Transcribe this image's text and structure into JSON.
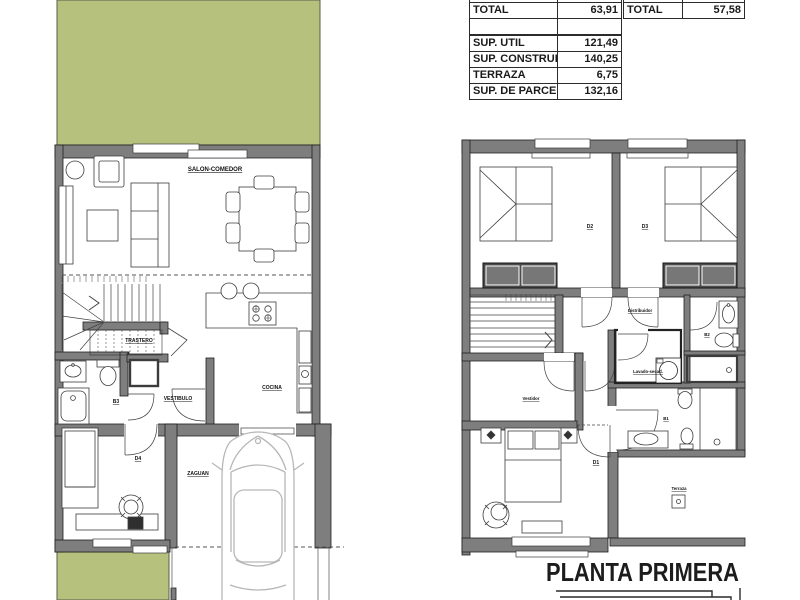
{
  "title": "PLANTA PRIMERA",
  "tables": {
    "left": {
      "total": {
        "label": "TOTAL",
        "value": "63,91"
      },
      "rows": [
        {
          "label": "SUP. UTIL",
          "value": "121,49"
        },
        {
          "label": "SUP. CONSTRUIDA",
          "value": "140,25"
        },
        {
          "label": "TERRAZA",
          "value": "6,75"
        },
        {
          "label": "SUP. DE PARCELA",
          "value": "132,16"
        }
      ]
    },
    "right": {
      "total": {
        "label": "TOTAL",
        "value": "57,58"
      }
    }
  },
  "plans": {
    "left": {
      "salon": "SALON-COMEDOR",
      "trastero": "TRASTERO",
      "b3": "B3",
      "vestibulo": "VESTIBULO",
      "cocina": "COCINA",
      "d4": "D4",
      "zaguan": "ZAGUAN"
    },
    "right": {
      "d2": "D2",
      "d3": "D3",
      "distribuidor": "Distribuidor",
      "b2": "B2",
      "lavado": "Lavado-secad.",
      "vestidor": "Vestidor",
      "b1": "B1",
      "d1": "D1",
      "terraza": "Terraza"
    }
  },
  "colors": {
    "garden_green": "#b7c17e",
    "wall_gray": "#7e7e7e",
    "line_dark": "#1f1f1f",
    "wardrobe_dark": "#4c4c4c",
    "car_gray": "#b7b7b7"
  }
}
